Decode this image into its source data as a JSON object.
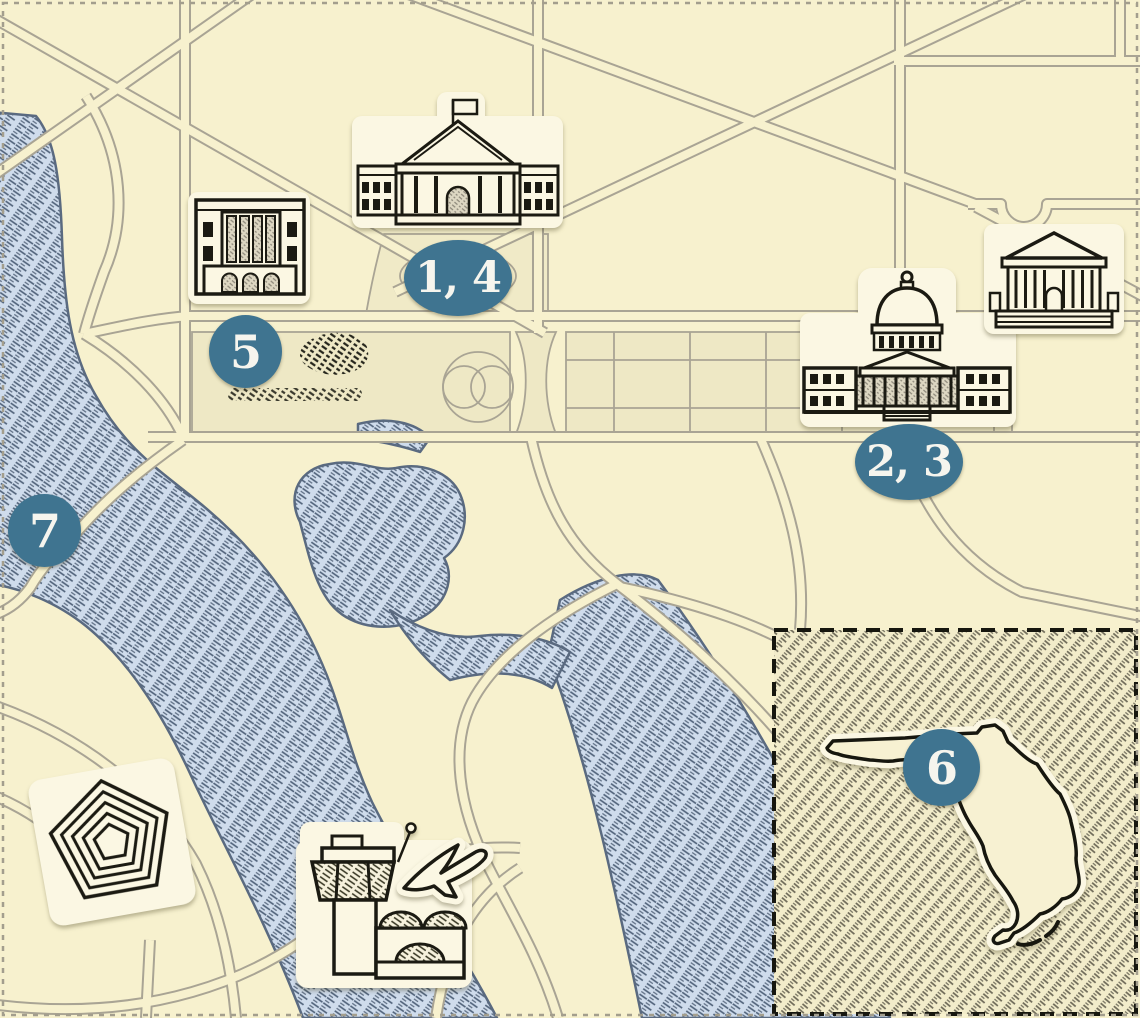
{
  "map": {
    "kind": "illustrated-landmark-map",
    "badges": {
      "white_house": "1, 4",
      "capitol": "2, 3",
      "federal_building": "5",
      "florida": "6",
      "potomac": "7"
    },
    "landmarks": [
      {
        "id": "white-house",
        "icon": "white-house-icon",
        "badge": "1, 4"
      },
      {
        "id": "us-capitol",
        "icon": "capitol-dome-icon",
        "badge": "2, 3"
      },
      {
        "id": "federal-building",
        "icon": "classical-building-icon",
        "badge": "5"
      },
      {
        "id": "supreme-court",
        "icon": "courthouse-icon",
        "badge": ""
      },
      {
        "id": "pentagon",
        "icon": "pentagon-icon",
        "badge": ""
      },
      {
        "id": "airport",
        "icon": "control-tower-icon",
        "badge": ""
      },
      {
        "id": "airplane",
        "icon": "airplane-icon",
        "badge": ""
      },
      {
        "id": "florida-state",
        "icon": "florida-outline-icon",
        "badge": "6"
      },
      {
        "id": "potomac-river",
        "icon": "water-hatch",
        "badge": "7"
      }
    ],
    "colors": {
      "background": "#f7f1ce",
      "road_line": "#a9a494",
      "mall_panel": "#eee8c5",
      "water_fill": "#cfdcec",
      "water_hatch": "#4e6078",
      "water_edge": "#5a6a80",
      "badge_fill": "#3f7490",
      "badge_text": "#f6f5ee",
      "icon_ink": "#1b1a12",
      "icon_card": "#fbf7e3",
      "inset_hatch": "#6e6a58",
      "inset_border": "#17170f"
    }
  }
}
